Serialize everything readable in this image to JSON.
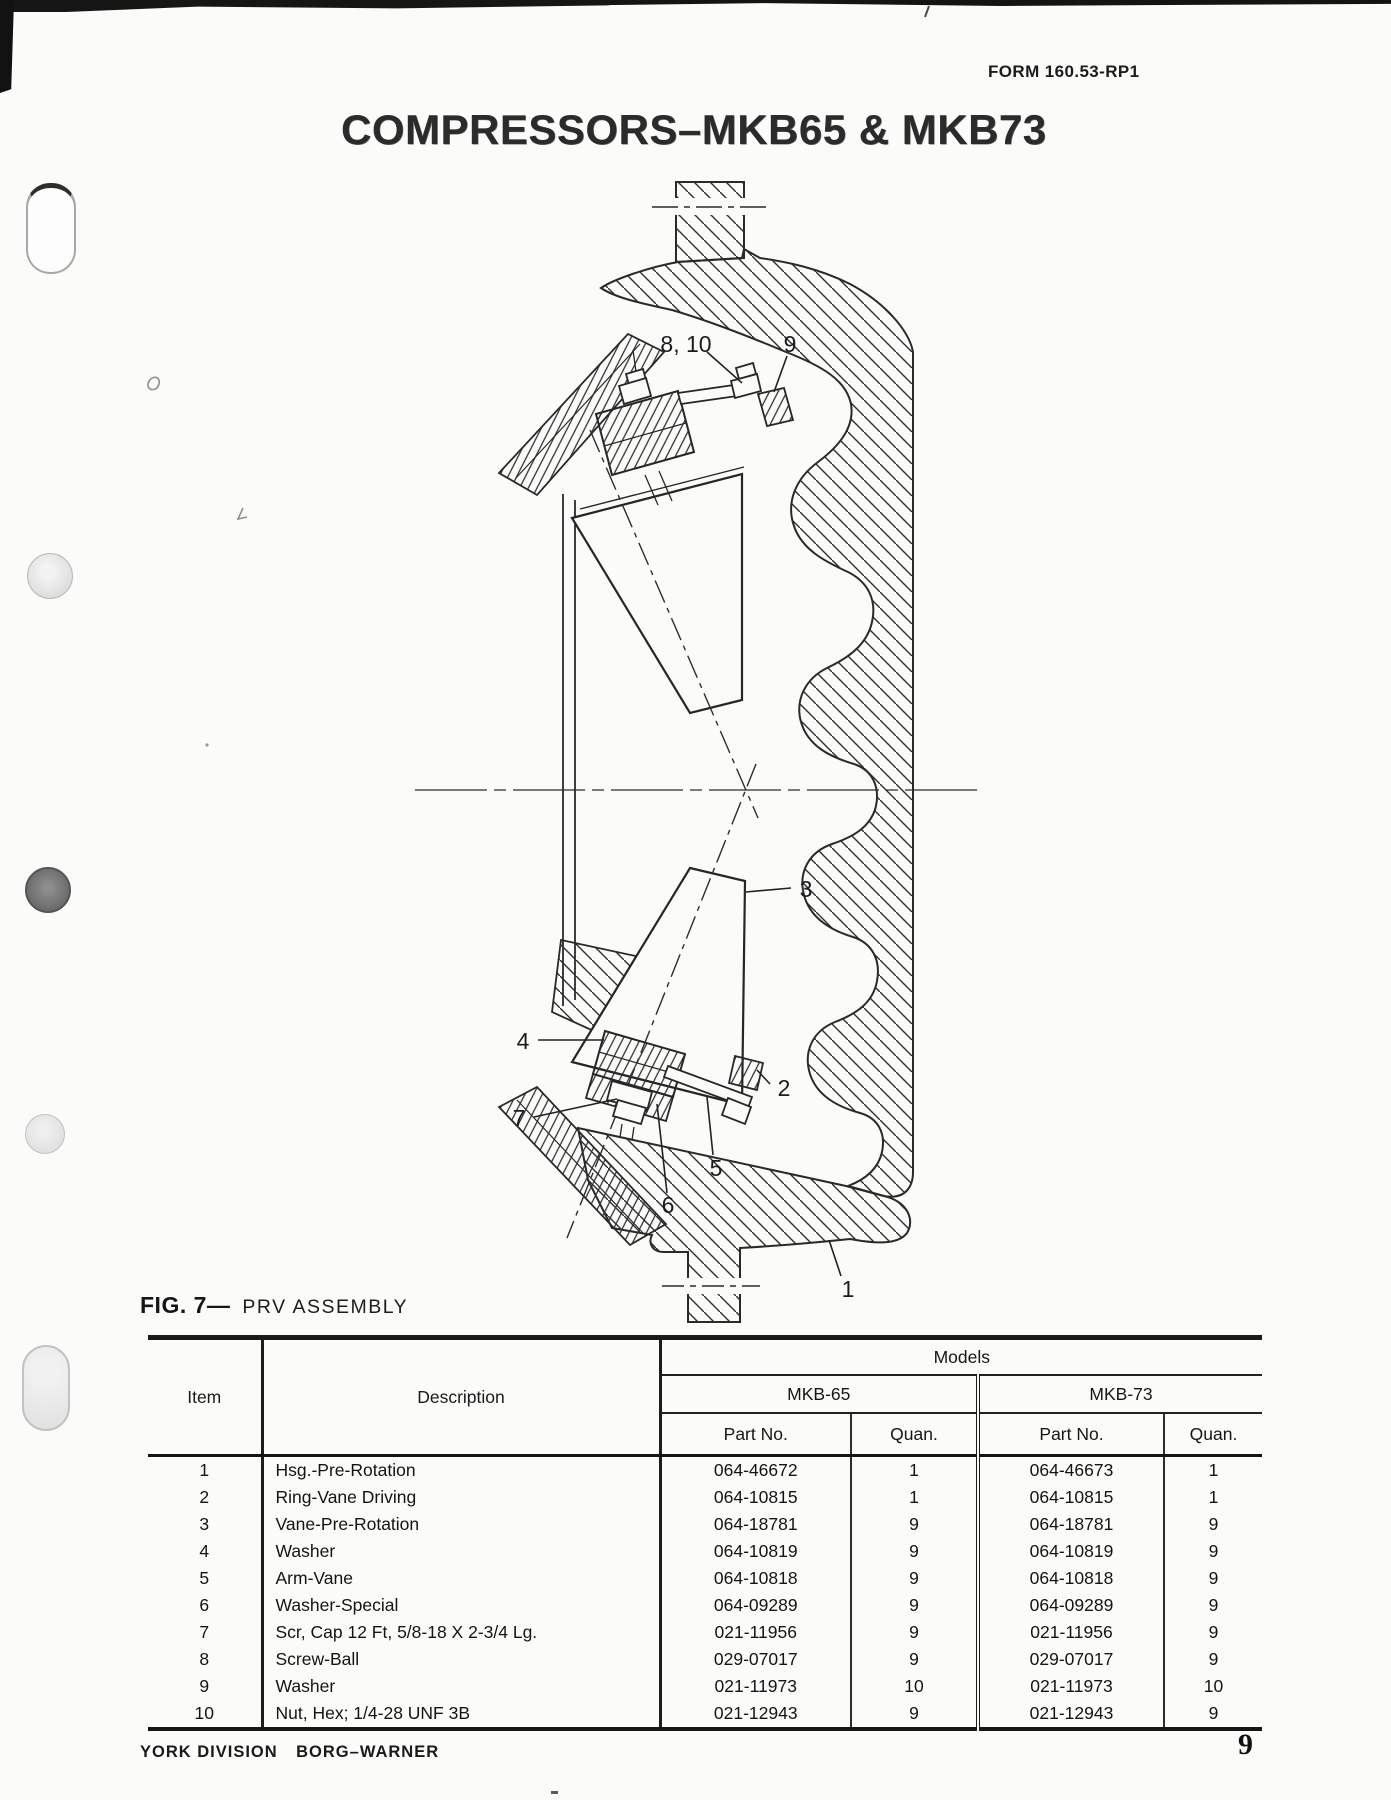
{
  "page": {
    "form_number": "FORM 160.53-RP1",
    "title": "COMPRESSORS–MKB65 & MKB73",
    "figure_label": "FIG. 7—",
    "figure_title": "PRV ASSEMBLY",
    "footer_division": "YORK DIVISION",
    "footer_company": "BORG–WARNER",
    "page_number": "9"
  },
  "colors": {
    "ink": "#1e1e1e",
    "paper": "#fbfbfa"
  },
  "diagram": {
    "name": "PRV assembly cross-section",
    "callouts": [
      {
        "label": "8, 10"
      },
      {
        "label": "9"
      },
      {
        "label": "3"
      },
      {
        "label": "4"
      },
      {
        "label": "2"
      },
      {
        "label": "7"
      },
      {
        "label": "5"
      },
      {
        "label": "6"
      },
      {
        "label": "1"
      }
    ]
  },
  "table": {
    "headers": {
      "item": "Item",
      "description": "Description",
      "models": "Models",
      "model1": "MKB-65",
      "model2": "MKB-73",
      "part_no": "Part No.",
      "quan": "Quan."
    },
    "rows": [
      [
        "1",
        "Hsg.-Pre-Rotation",
        "064-46672",
        "1",
        "064-46673",
        "1"
      ],
      [
        "2",
        "Ring-Vane Driving",
        "064-10815",
        "1",
        "064-10815",
        "1"
      ],
      [
        "3",
        "Vane-Pre-Rotation",
        "064-18781",
        "9",
        "064-18781",
        "9"
      ],
      [
        "4",
        "Washer",
        "064-10819",
        "9",
        "064-10819",
        "9"
      ],
      [
        "5",
        "Arm-Vane",
        "064-10818",
        "9",
        "064-10818",
        "9"
      ],
      [
        "6",
        "Washer-Special",
        "064-09289",
        "9",
        "064-09289",
        "9"
      ],
      [
        "7",
        "Scr, Cap 12 Ft, 5/8-18 X 2-3/4 Lg.",
        "021-11956",
        "9",
        "021-11956",
        "9"
      ],
      [
        "8",
        "Screw-Ball",
        "029-07017",
        "9",
        "029-07017",
        "9"
      ],
      [
        "9",
        "Washer",
        "021-11973",
        "10",
        "021-11973",
        "10"
      ],
      [
        "10",
        "Nut, Hex; 1/4-28 UNF 3B",
        "021-12943",
        "9",
        "021-12943",
        "9"
      ]
    ]
  }
}
